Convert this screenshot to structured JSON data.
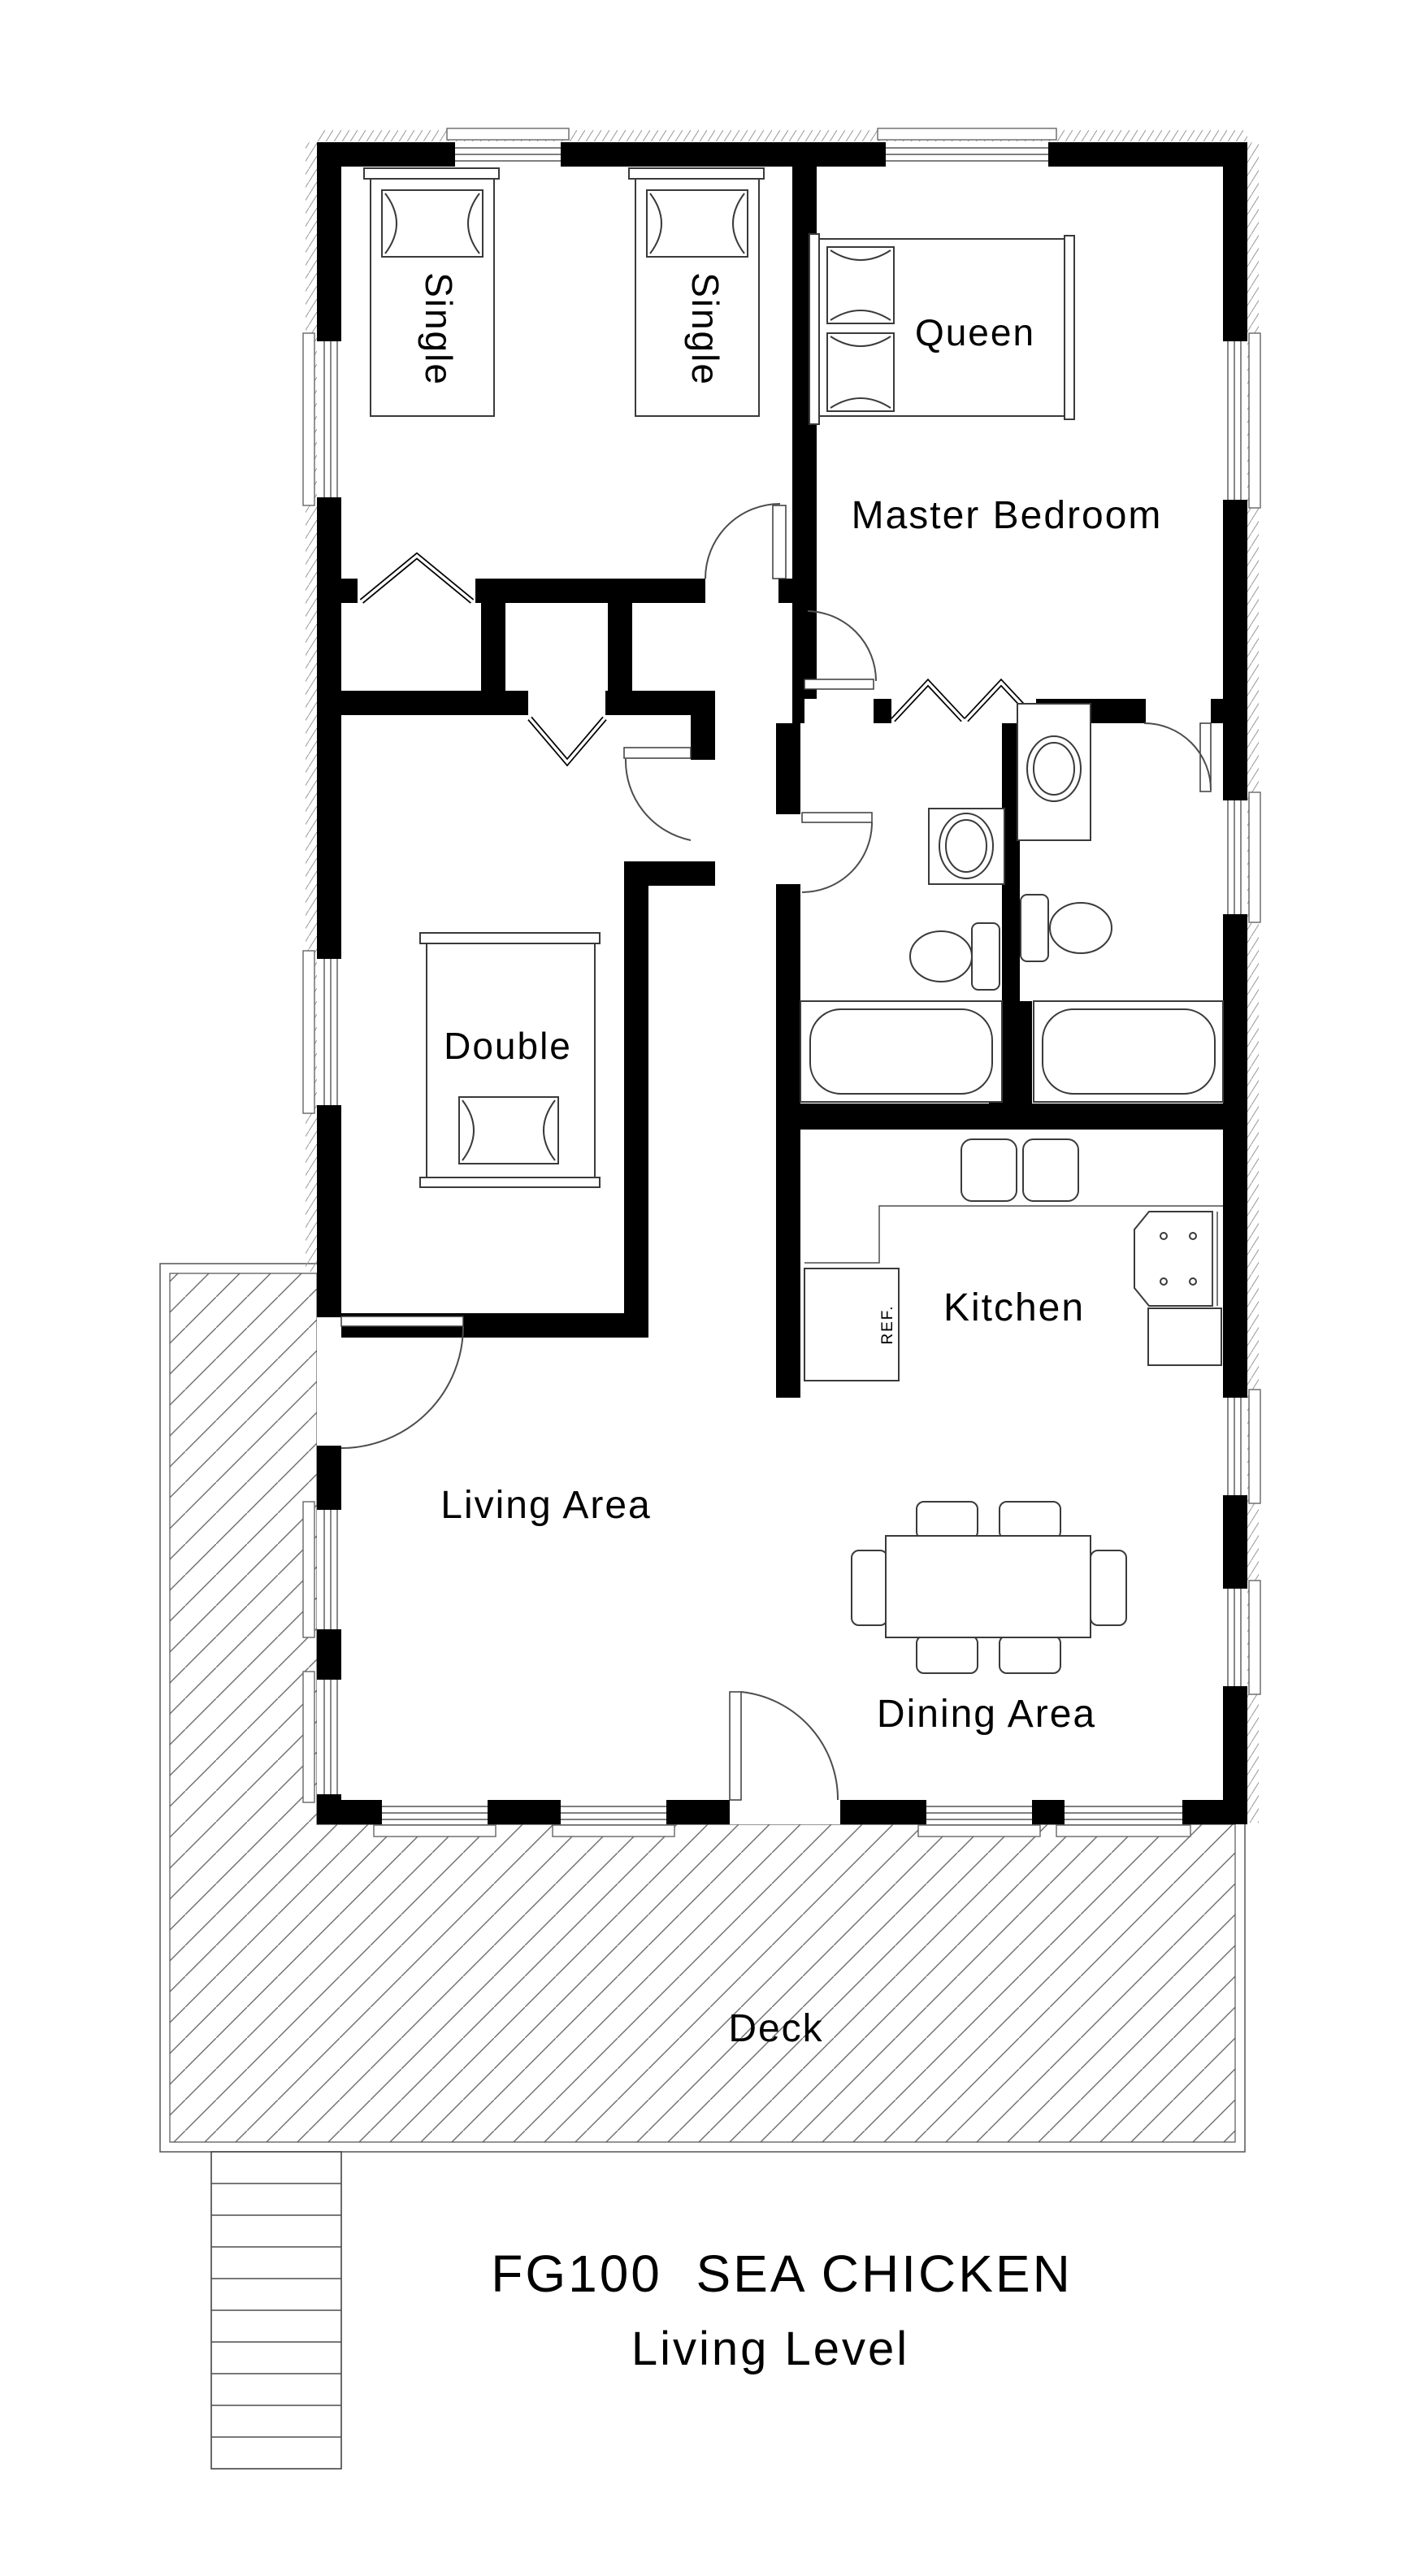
{
  "title": {
    "line1": "FG100  SEA CHICKEN",
    "line2": "Living Level"
  },
  "rooms": {
    "master_bedroom": "Master Bedroom",
    "kitchen": "Kitchen",
    "living_area": "Living Area",
    "dining_area": "Dining Area",
    "deck": "Deck"
  },
  "furniture": {
    "single_bed_1": "Single",
    "single_bed_2": "Single",
    "queen_bed": "Queen",
    "double_bed": "Double",
    "refrigerator": "REF."
  },
  "colors": {
    "walls": "#000000",
    "furniture_lines": "#3a3a3a",
    "hatch": "#6e6e6e",
    "background": "#ffffff",
    "text": "#000000"
  }
}
